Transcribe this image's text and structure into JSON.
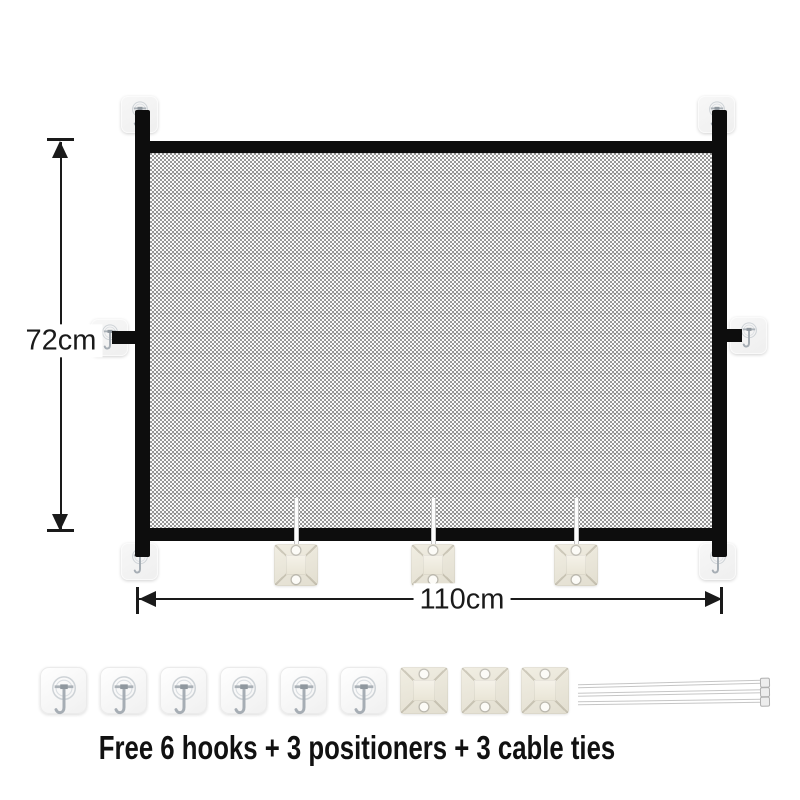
{
  "illustration": {
    "type": "product-dimension-diagram",
    "subject": "mesh safety gate with adhesive hooks and positioners",
    "height_label": "72cm",
    "width_label": "110cm",
    "caption": "Free 6 hooks + 3 positioners + 3 cable ties",
    "freebies": {
      "hooks": 6,
      "positioners": 3,
      "cable_ties": 3
    },
    "gate_adhesive_pads": 6,
    "gate_positioners": 3
  },
  "colors": {
    "background": "#ffffff",
    "frame": "#0d0d0d",
    "mesh_dark": "#969696",
    "mesh_light": "#fafafa",
    "adhesive_pad": "#f4f4f4",
    "positioner": "#e9e5d8",
    "cable_tie": "#c6c6c6",
    "dimension_lines": "#1a1a1a",
    "caption_text": "#111111"
  },
  "icons": {
    "hook": "adhesive-hook-icon",
    "positioner": "positioner-mount-icon",
    "cable_tie": "cable-tie-icon"
  }
}
